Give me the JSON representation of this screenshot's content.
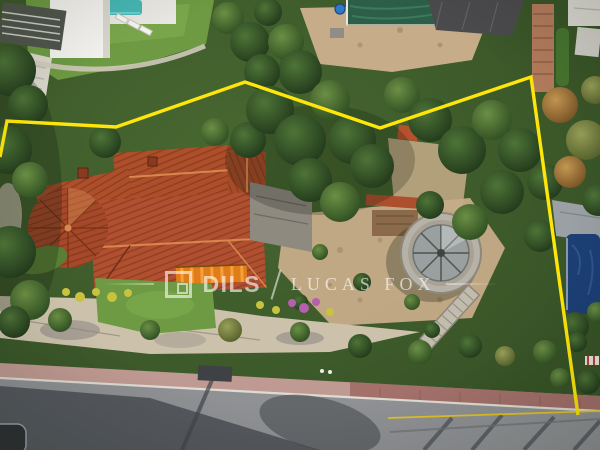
{
  "watermark": {
    "logo_name": "dils-square-logo",
    "brand_primary": "DILS",
    "divider": "/",
    "brand_secondary": "LUCAS FOX",
    "text_color": "#ffffff"
  },
  "annotation": {
    "plot_boundary_color": "#ffe60a",
    "plot_boundary_points": "0,157 7,121 116,127 245,82 380,128 531,77 578,415",
    "road_marking_color": "#e6c51f",
    "road_marking_points": "388,418 600,411"
  },
  "scene": {
    "palette": {
      "roof_terracotta": "#ad4f2a",
      "lawn_green": "#6d9a42",
      "dirt_tan": "#c7ac89",
      "road_asphalt": "#8f9194",
      "sidewalk_red": "#bf9a92",
      "pool_turquoise": "#46b7b4",
      "pool_dark_green": "#2d5f48",
      "pool_dark_blue": "#1c3f75",
      "vegetation_dark": "#2d4a24"
    }
  }
}
